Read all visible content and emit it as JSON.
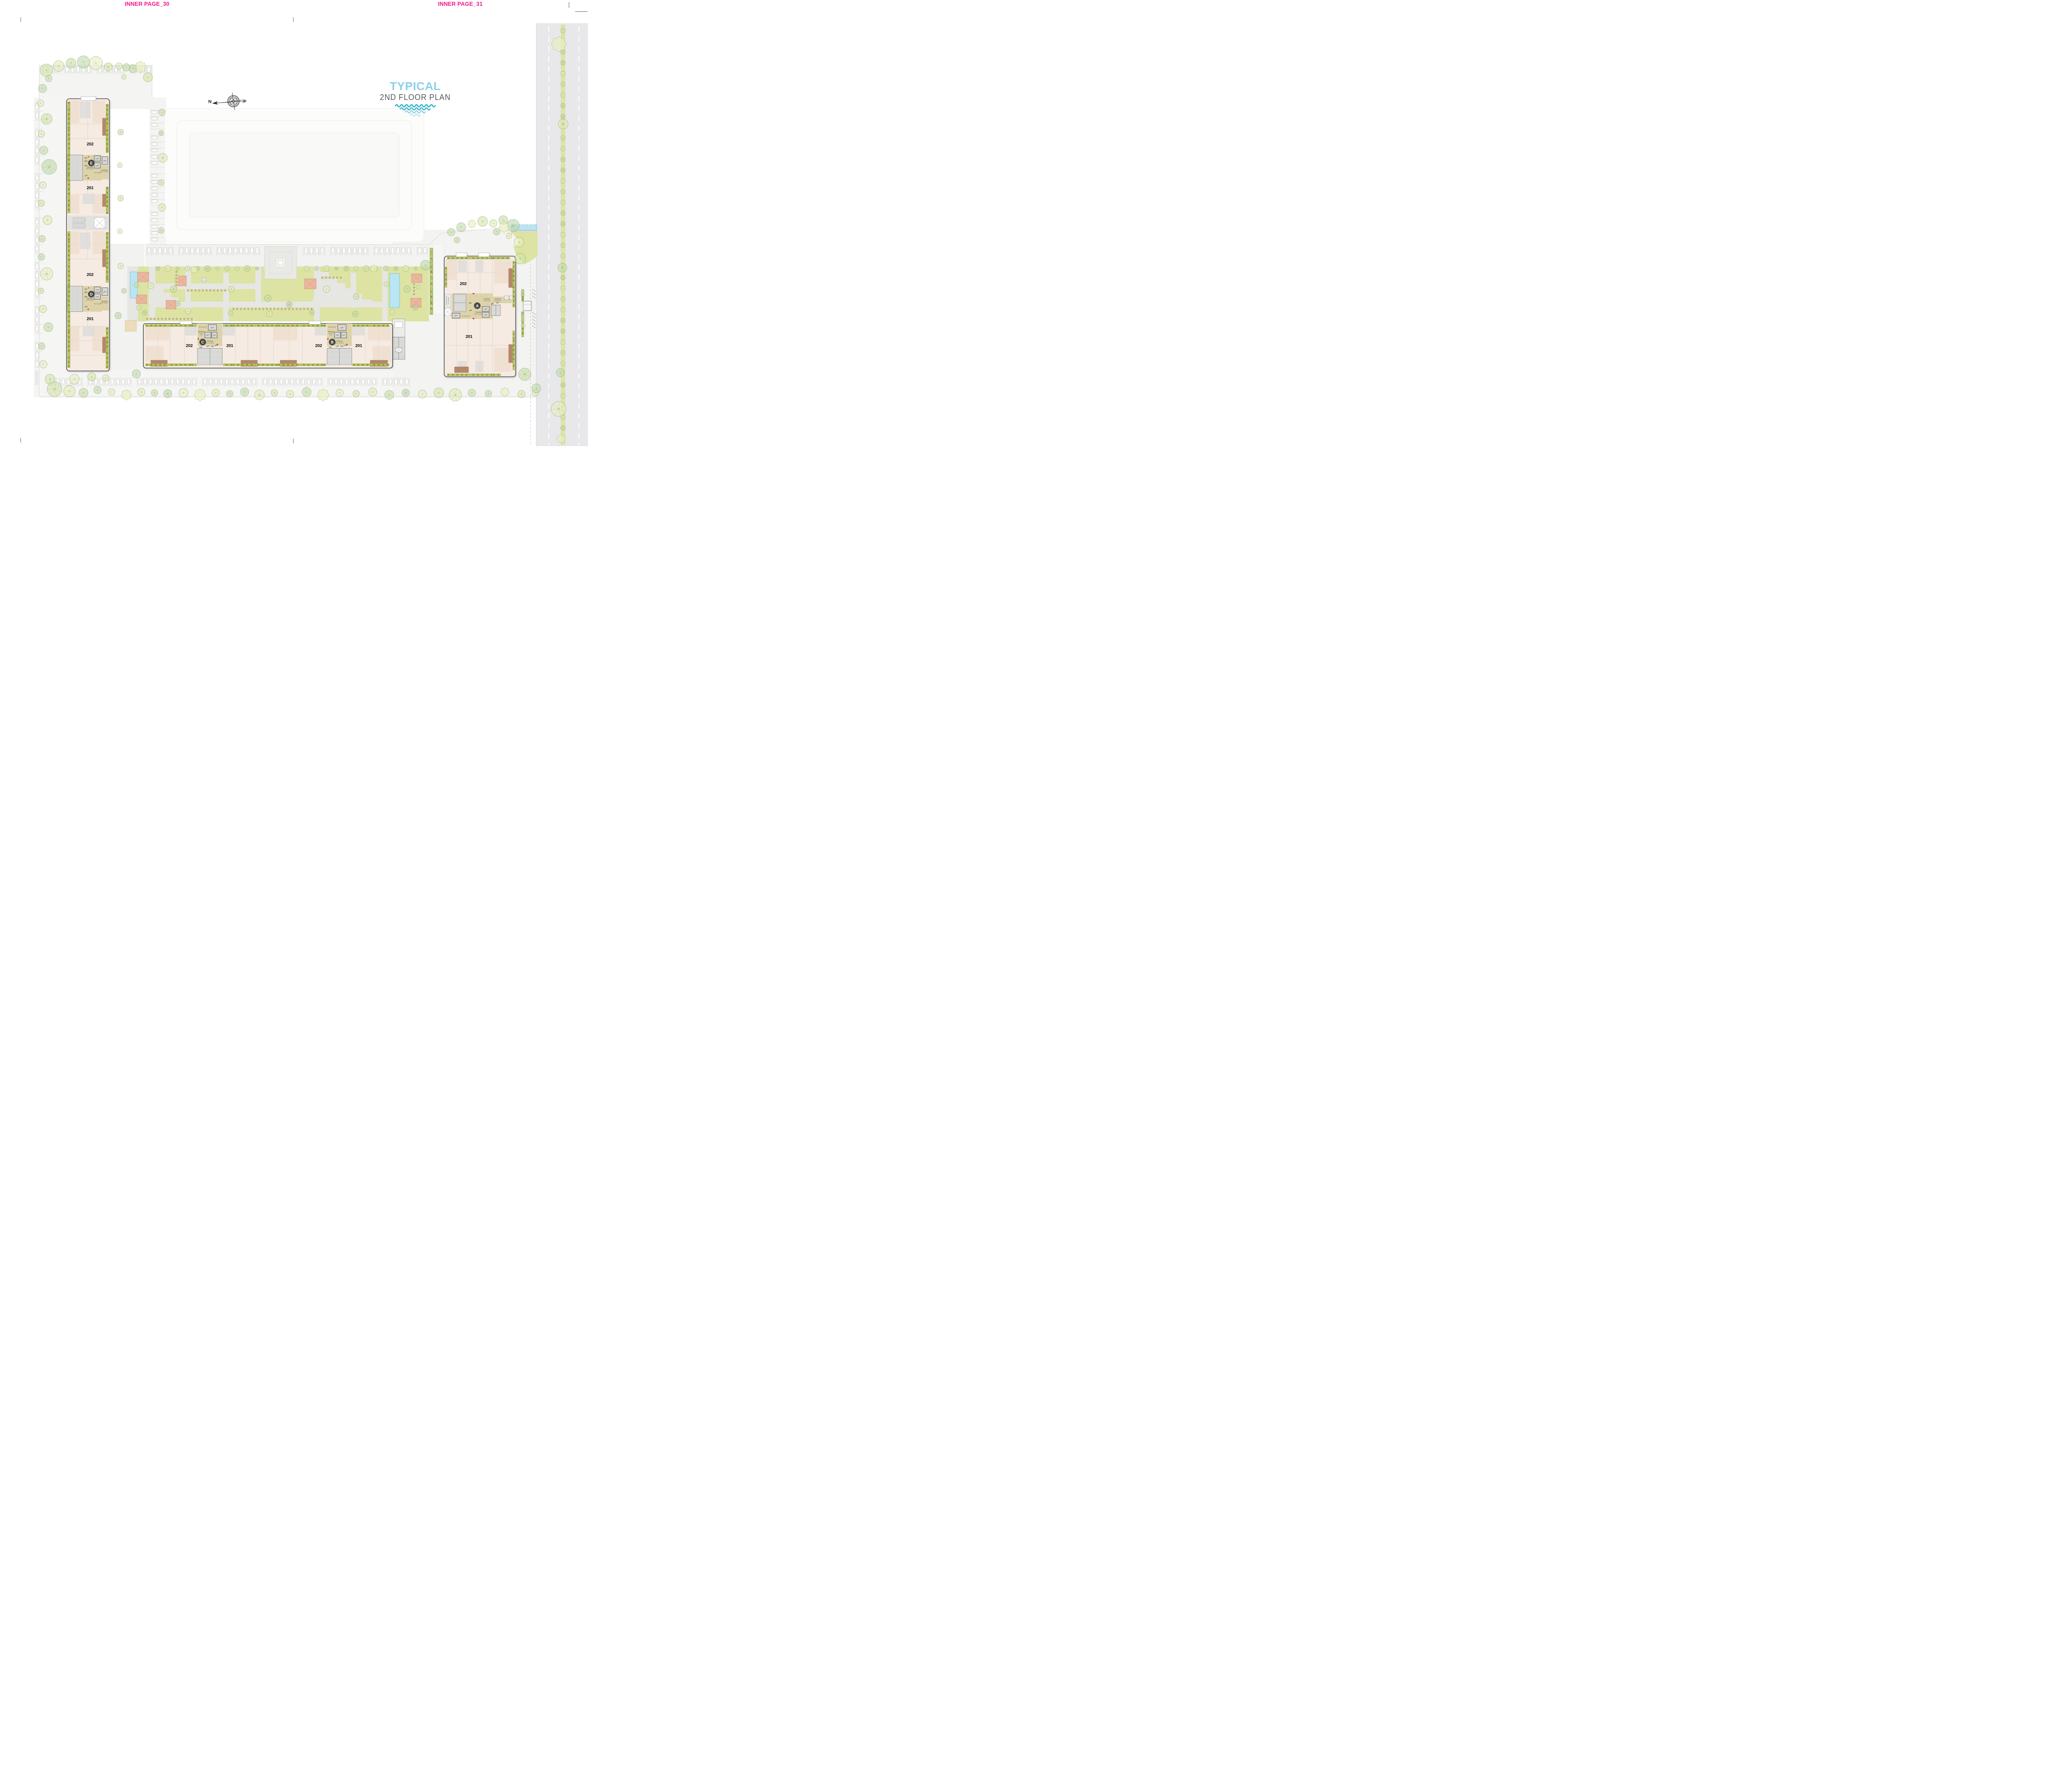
{
  "page": {
    "header_left": "INNER PAGE_30",
    "header_right": "INNER PAGE_31"
  },
  "title": {
    "line1": "TYPICAL",
    "line2": "2ND FLOOR PLAN"
  },
  "compass": {
    "north_label": "N"
  },
  "labels": {
    "lift": "LIFT",
    "up": "UP",
    "dn": "DN",
    "passage": "PASSAGE",
    "unit_202": "202",
    "unit_201": "201"
  },
  "blocks": {
    "E": {
      "badge": "E",
      "passage_dim": "9' 6\" X 23' 2\"",
      "lobby_dim": "7' 9\" X 6' 10\"",
      "side_passage_dim": "10' 7\" X 6' 3\""
    },
    "D": {
      "badge": "D",
      "passage_dim": "9' 6\" X 23' 2\"",
      "lobby_dim": "7' 9\" X 6' 10\"",
      "side_passage_dim": "6' 3\" X 10' 7\""
    },
    "C": {
      "badge": "C",
      "entry_dim": "8' 11\" X 6' 4\"",
      "small_passage_dim_1": "4' 10\" X",
      "small_passage_dim_2": "7' 6\"",
      "passage_dim": "21' 2\" X 10' 9\""
    },
    "B": {
      "badge": "B",
      "entry_dim": "8' 11\" X 6' 4\"",
      "small_passage_dim_1": "4' 10\" X",
      "small_passage_dim_2": "7' 6\"",
      "passage_dim": "21' 2\" X 10' 9\""
    },
    "A": {
      "badge": "A",
      "passage_dim": "21' 2\" X 10' 0\"",
      "lobby_dim": "5' 11\" X 6' 4\"",
      "passage2_dim": "7' 9\" X 4' 0\"",
      "passage3_dim": "8' 0\" X 5' 7\"",
      "ac_note_line1": "SPACE FOR AC",
      "ac_note_line2": "OUT DOOR"
    }
  },
  "colors": {
    "header_pink": "#ED168D",
    "title_blue": "#8CD0E8",
    "title_gray": "#58595B",
    "wave_teal": "#2FB0CD",
    "walls": "#4D4D4D",
    "core_passage": "#DDD3AB",
    "floor": "#F5EBE2",
    "hedge": "#A9B44D",
    "lawn": "#DDE3A2",
    "pool": "#B8E6F2",
    "gazebo_roof": "#ECB79E",
    "balcony_wood": "#B5886B",
    "road": "#E8E8EA"
  }
}
